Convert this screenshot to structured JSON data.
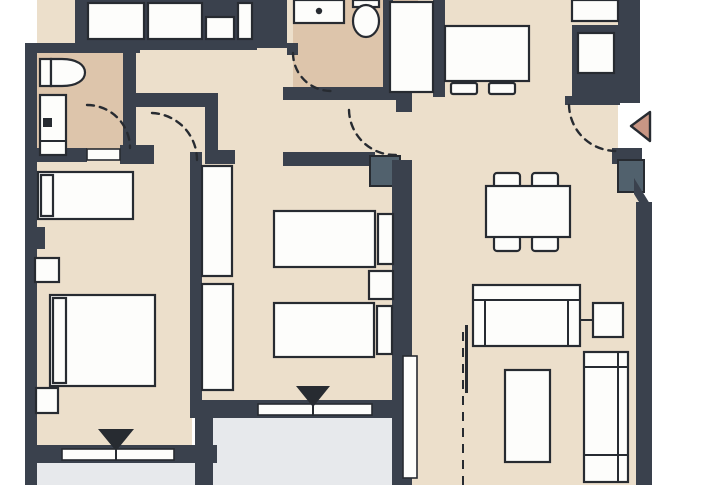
{
  "palette": {
    "outside": "#ffffff",
    "floor": "#ecdfcb",
    "bath_floor": "#ddc5ab",
    "balcony": "#e7e9ec",
    "wall": "#3a414d",
    "line": "#272b31",
    "furniture": "#fdfdfb",
    "shaft": "#51616d",
    "arrow": "#c89684"
  },
  "plan": {
    "type": "apartment-floor-plan",
    "rooms": [
      "bathroom-1",
      "bathroom-2",
      "hallway",
      "kitchen-dining",
      "living-room",
      "bedroom-1",
      "bedroom-2",
      "balcony-left",
      "balcony-main"
    ],
    "markers": {
      "entrance_arrow_direction": "left",
      "window_marker_count": 2,
      "door_arc_count": 5
    }
  }
}
